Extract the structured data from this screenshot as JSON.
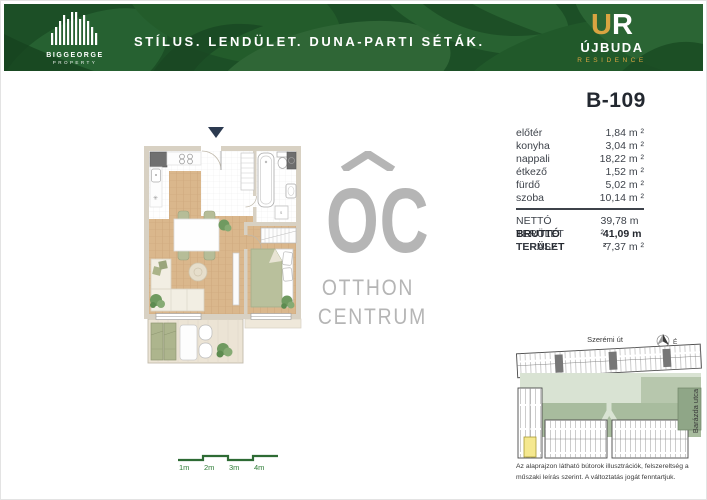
{
  "header": {
    "tagline": "STÍLUS. LENDÜLET. DUNA-PARTI SÉTÁK.",
    "biggeorge": {
      "name": "BIGGEORGE",
      "sub": "PROPERTY"
    },
    "ujbuda": {
      "mark_u": "U",
      "mark_r": "R",
      "name": "ÚJBUDA",
      "sub": "RESIDENCE"
    },
    "colors": {
      "header_green": "#1e5329",
      "gold": "#d9a441"
    }
  },
  "unit": {
    "title": "B-109"
  },
  "rooms": [
    {
      "label": "előtér",
      "value": "1,84 m ²"
    },
    {
      "label": "konyha",
      "value": "3,04 m ²"
    },
    {
      "label": "nappali",
      "value": "18,22 m ²"
    },
    {
      "label": "étkező",
      "value": "1,52 m ²"
    },
    {
      "label": "fürdő",
      "value": "5,02 m ²"
    },
    {
      "label": "szoba",
      "value": "10,14 m ²"
    }
  ],
  "totals": [
    {
      "label": "NETTÓ TERÜLET",
      "value": "39,78 m ²"
    },
    {
      "label": "BRUTTÓ TERÜLET",
      "value": "41,09 m ²"
    },
    {
      "label": "TERASZ",
      "value": "7,37 m ²"
    }
  ],
  "siteplan": {
    "street_top": "Szerémi út",
    "street_right": "Barázda utca",
    "compass": "É"
  },
  "scalebar": {
    "labels": [
      "1m",
      "2m",
      "3m",
      "4m"
    ]
  },
  "watermark": {
    "line1": "OTTHON",
    "line2": "CENTRUM",
    "mark": "OC"
  },
  "disclaimer": {
    "line1": "Az alaprajzon látható bútorok illusztrációk, felszereltség a",
    "line2": "műszaki leírás szerint. A változtatás jogát fenntartjuk."
  }
}
